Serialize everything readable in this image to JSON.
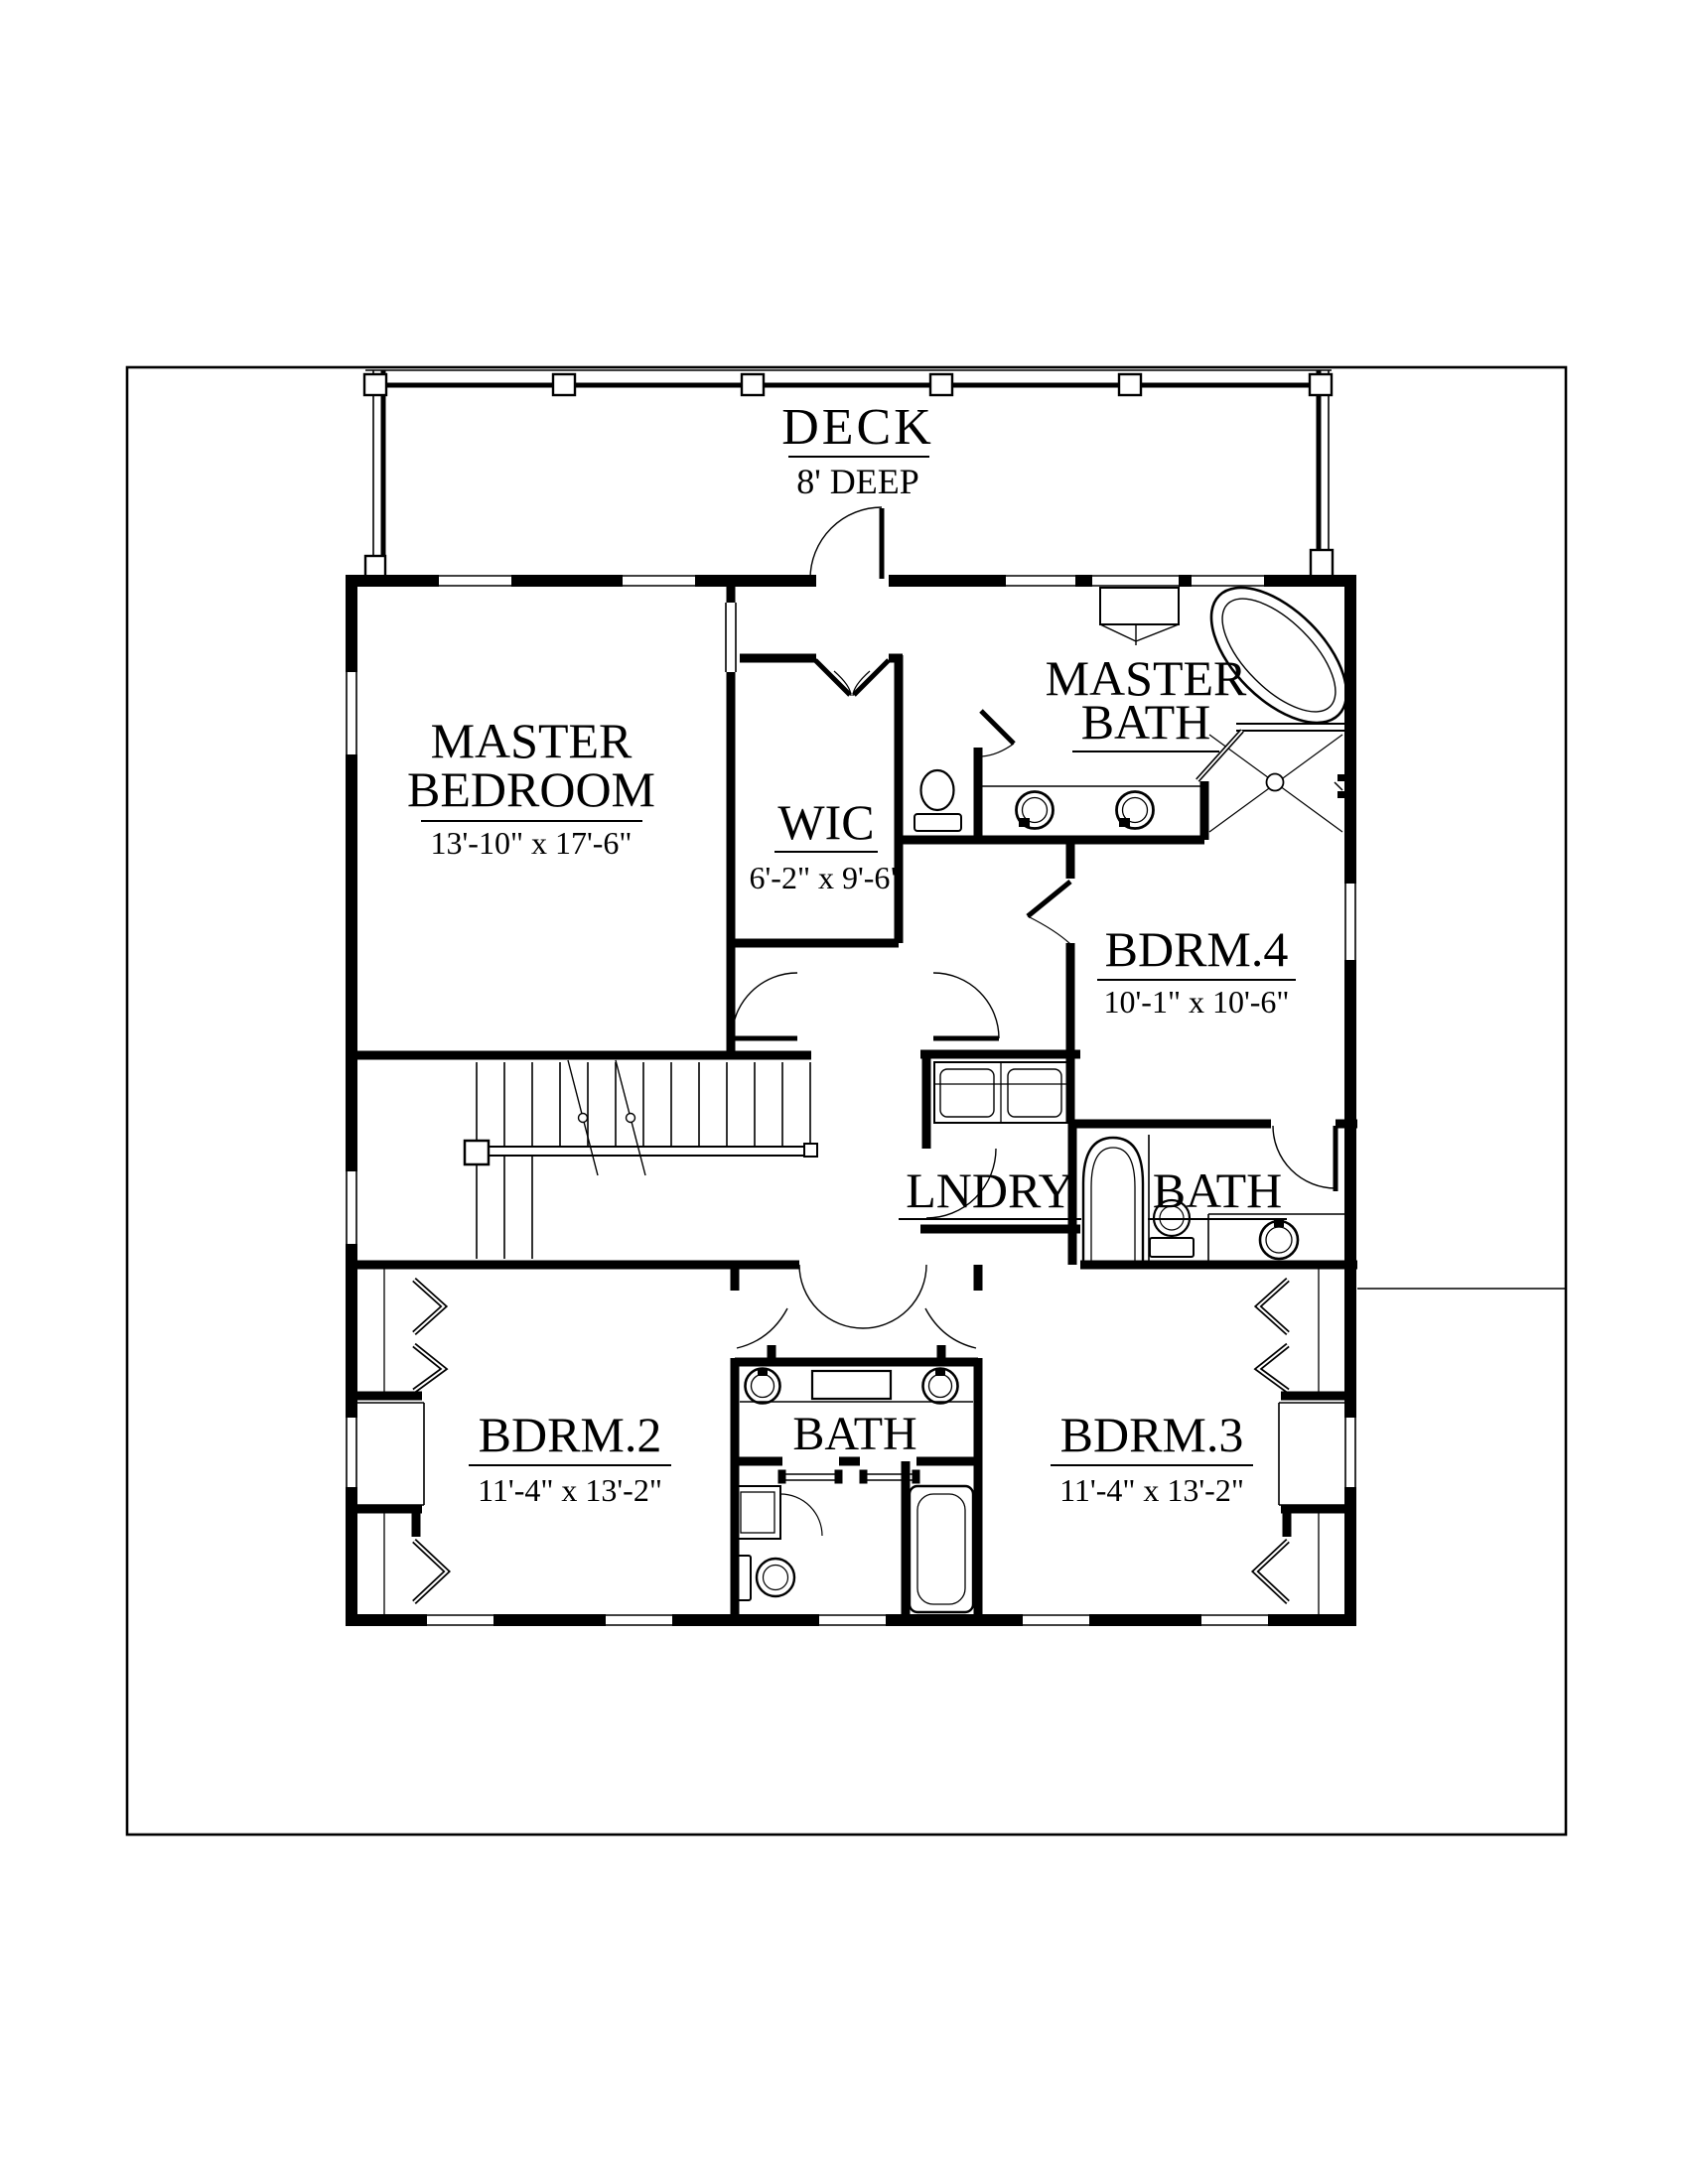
{
  "style": {
    "line_color": "#000000",
    "background": "#ffffff"
  },
  "deck": {
    "label": "DECK",
    "depth": "8' DEEP"
  },
  "rooms": {
    "master_bedroom": {
      "line1": "MASTER",
      "line2": "BEDROOM",
      "dims": "13'-10\" x 17'-6\""
    },
    "wic": {
      "line1": "WIC",
      "dims": "6'-2\" x 9'-6\""
    },
    "master_bath": {
      "line1": "MASTER",
      "line2": "BATH"
    },
    "bdrm4": {
      "line1": "BDRM.4",
      "dims": "10'-1\" x 10'-6\""
    },
    "laundry": {
      "line1": "LNDRY"
    },
    "hall_bath": {
      "line1": "BATH"
    },
    "bdrm2": {
      "line1": "BDRM.2",
      "dims": "11'-4\" x 13'-2\""
    },
    "shared_bath": {
      "line1": "BATH"
    },
    "bdrm3": {
      "line1": "BDRM.3",
      "dims": "11'-4\" x 13'-2\""
    }
  }
}
